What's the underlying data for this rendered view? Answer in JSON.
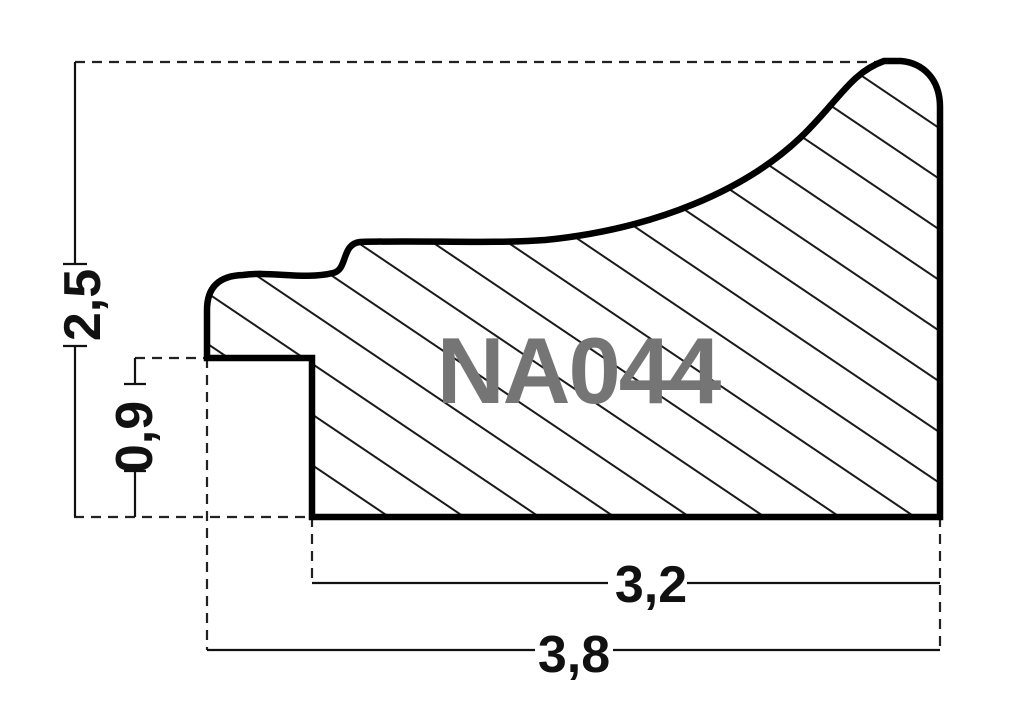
{
  "drawing": {
    "profile_code": "NA044",
    "dimensions": {
      "overall_height": "2,5",
      "rabbet_height": "0,9",
      "base_width": "3,2",
      "overall_width": "3,8"
    },
    "colors": {
      "outline": "#000000",
      "hatch": "#1a1a1a",
      "dimension": "#111111",
      "profile_code_text": "#757575",
      "background": "#ffffff"
    }
  }
}
